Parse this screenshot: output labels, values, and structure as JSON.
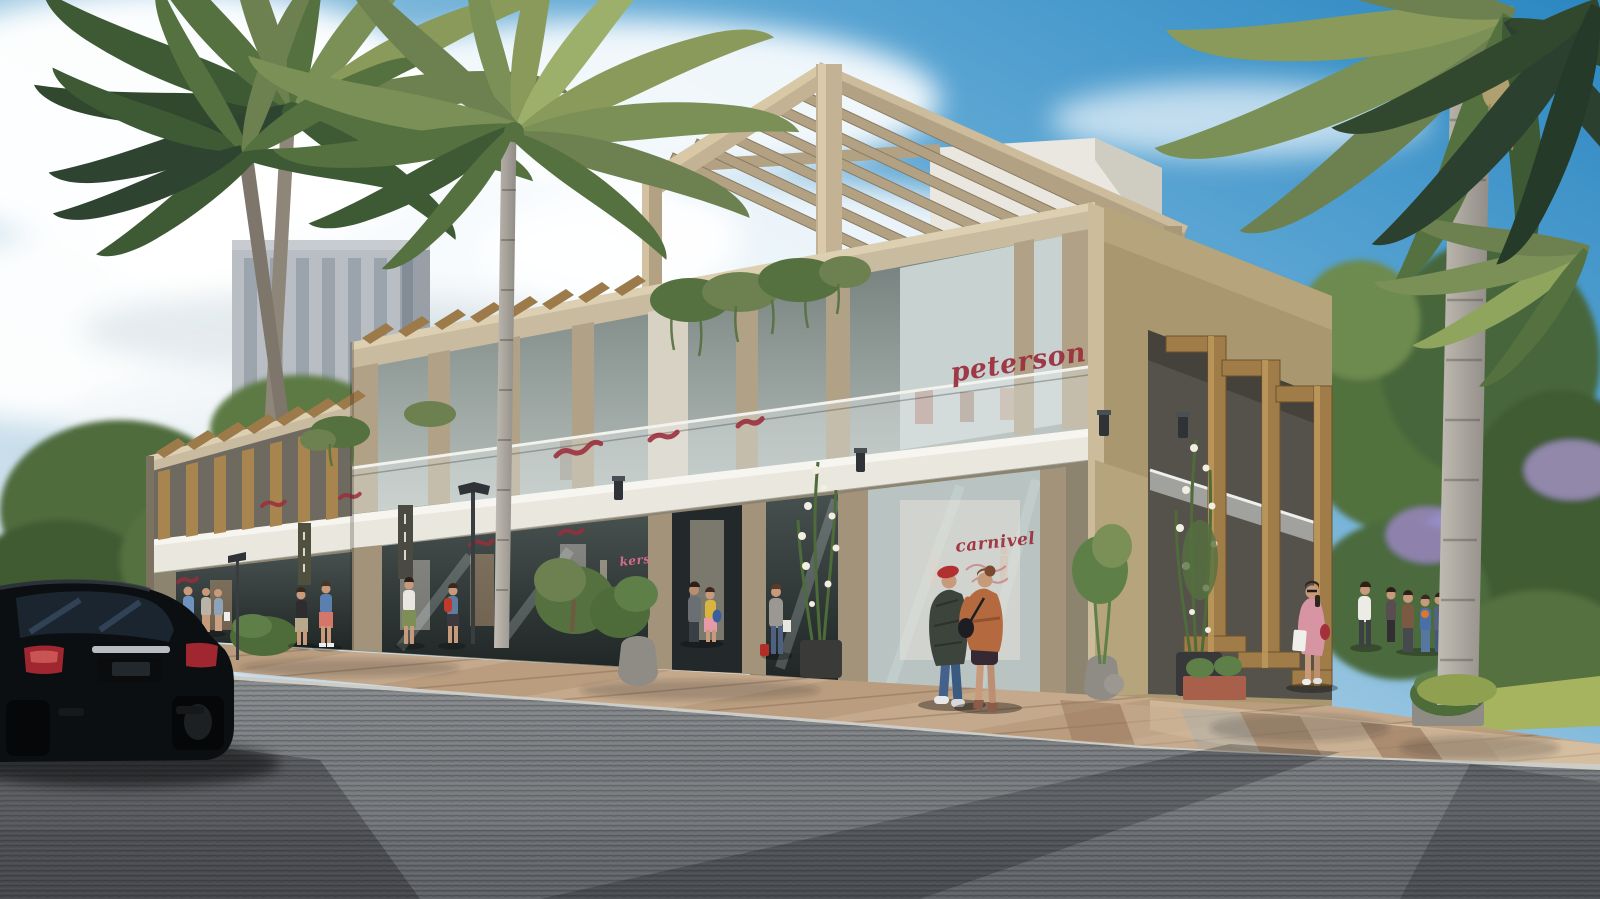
{
  "meta": {
    "title": "Retail plaza architectural rendering"
  },
  "scene": {
    "description": "Sunny photorealistic architectural rendering of a beige two-storey corner retail plaza with a rooftop pergola, glass storefronts, balconies with hanging ivy, tall palm trees, shoppers on a tiled corner plaza, and a black luxury sedan parked on the asphalt street in the foreground.",
    "signs": {
      "upper_store": "peterson",
      "lower_store": "carnivel",
      "partial_store": "kers"
    },
    "colors": {
      "sky_deep": "#2b87c1",
      "sky_pale": "#e9f1f5",
      "cloud": "#ffffff",
      "tower_grey": "#b9bec4",
      "building_tan": "#bfae8d",
      "building_tan_shadow": "#8d7f66",
      "fascia_white": "#eae7df",
      "wood": "#a07c48",
      "wood_dark": "#7c5c33",
      "glass_dark": "#2e3434",
      "glass_light": "#c5cfcd",
      "street": "#7c7f83",
      "street_shadow": "#515459",
      "sidewalk_tan": "#c5a98c",
      "sidewalk_brown": "#9a7a5f",
      "curb": "#cdccc6",
      "foliage": "#5f7f49",
      "foliage_dark": "#37512f",
      "foliage_light": "#93a763",
      "trunk": "#9b9892",
      "car_body": "#0c0f12",
      "taillight": "#a02730",
      "sign_red": "#9c2d3c",
      "sign_pink": "#e2738f",
      "skin": "#c79a7c"
    }
  }
}
